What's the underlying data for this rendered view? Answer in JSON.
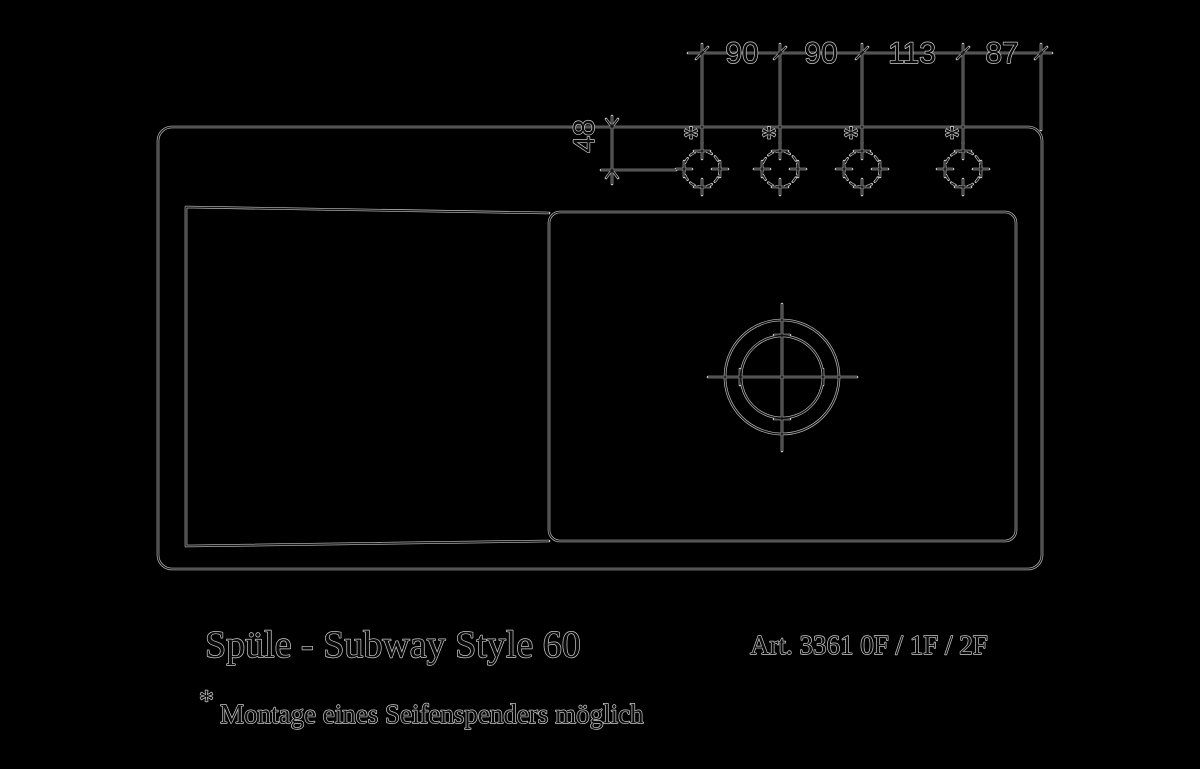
{
  "colors": {
    "background": "#000000",
    "line_halo": "#c3c3c3",
    "line_core": "#131313",
    "text_fill": "#0a0a0a",
    "text_outline": "#cacaca"
  },
  "product": {
    "title": "Spüle - Subway Style 60",
    "article_number": "Art. 3361 0F / 1F / 2F"
  },
  "footnote": {
    "marker": "*",
    "text": "Montage eines Seifenspenders möglich"
  },
  "dimensions": {
    "tap_hole_spacings": [
      "90",
      "90",
      "113",
      "87"
    ],
    "front_setback": "48"
  },
  "tap_holes": {
    "marker": "*",
    "count": 4
  }
}
